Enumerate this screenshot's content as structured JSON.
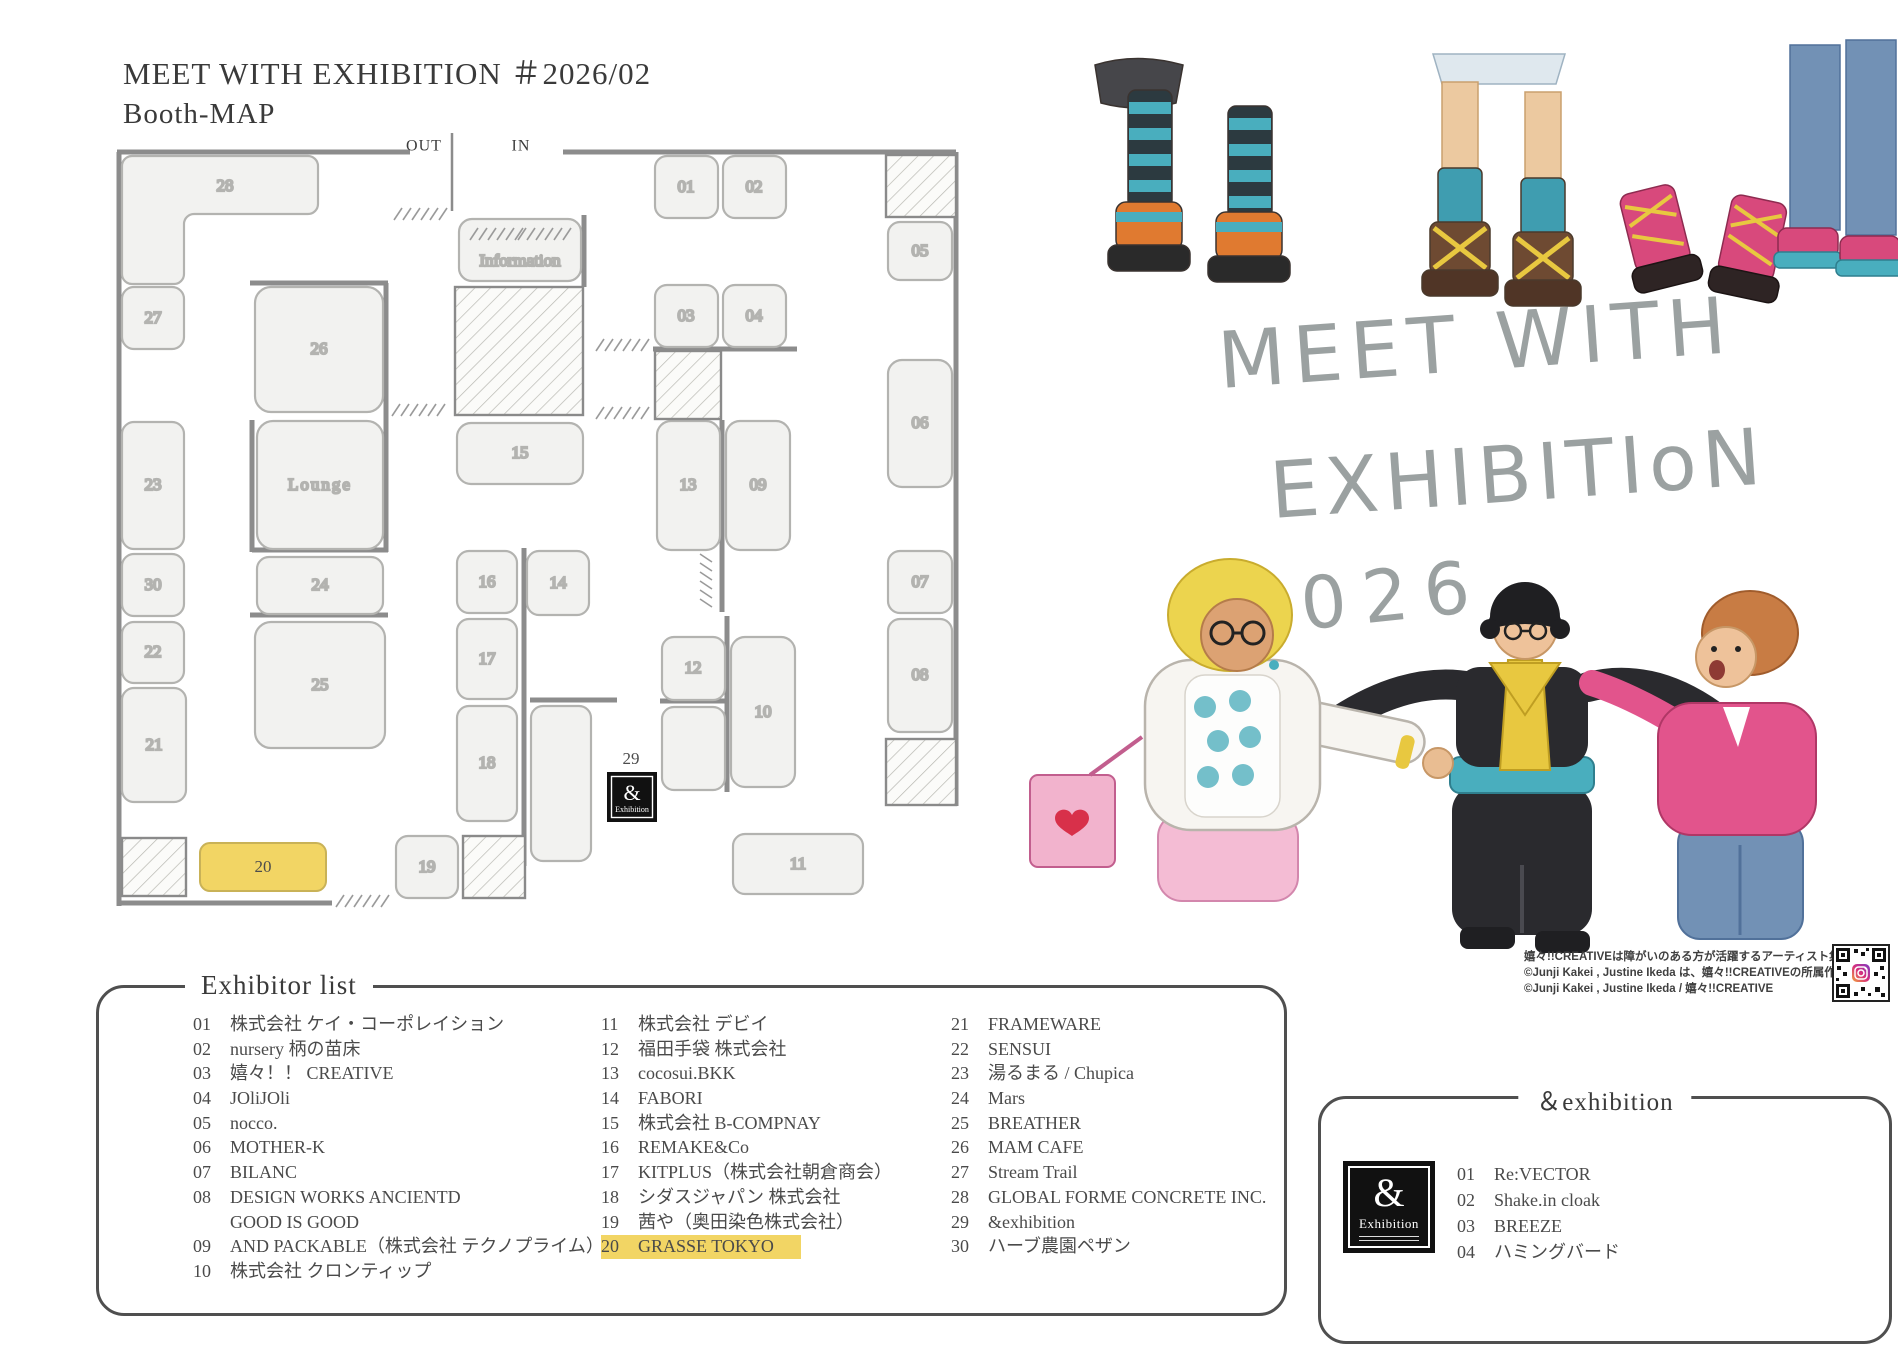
{
  "header": {
    "title": "MEET WITH EXHIBITION ＃2026/02",
    "subtitle": "Booth-MAP"
  },
  "map": {
    "out_label": "OUT",
    "in_label": "IN",
    "information_label": "Information",
    "lounge_label": "Lounge",
    "highlight_color": "#f2d564",
    "labels": {
      "b01": "01",
      "b02": "02",
      "b03": "03",
      "b04": "04",
      "b05": "05",
      "b06": "06",
      "b07": "07",
      "b08": "08",
      "b09": "09",
      "b10": "10",
      "b11": "11",
      "b12": "12",
      "b13": "13",
      "b14": "14",
      "b15": "15",
      "b16": "16",
      "b17": "17",
      "b18": "18",
      "b19": "19",
      "b20": "20",
      "b21": "21",
      "b22": "22",
      "b23": "23",
      "b24": "24",
      "b25": "25",
      "b26": "26",
      "b27": "27",
      "b28": "28",
      "b29": "29",
      "b30": "30"
    },
    "logo": {
      "amp": "&",
      "text": "Exhibition"
    }
  },
  "illustration": {
    "handwritten1": "MEET WITH",
    "handwritten2": "EXHIBITIoN",
    "handwritten3": "2026",
    "credits": {
      "line1": "嬉々!!CREATIVEは障がいのある方が活躍するアーティスト集団です！",
      "line2": "©Junji Kakei , Justine Ikeda は、嬉々!!CREATIVEの所属作家です。",
      "line3": "©Junji Kakei , Justine Ikeda / 嬉々!!CREATIVE"
    }
  },
  "exhibitor_list": {
    "title": "Exhibitor list",
    "col1": [
      {
        "no": "01",
        "name": "株式会社 ケイ・コーポレイション"
      },
      {
        "no": "02",
        "name": "nursery 柄の苗床"
      },
      {
        "no": "03",
        "name": "嬉々！！ CREATIVE"
      },
      {
        "no": "04",
        "name": "JOliJOli"
      },
      {
        "no": "05",
        "name": "nocco."
      },
      {
        "no": "06",
        "name": "MOTHER-K"
      },
      {
        "no": "07",
        "name": "BILANC"
      },
      {
        "no": "08",
        "name": "DESIGN WORKS ANCIENTD"
      },
      {
        "no": "",
        "name": "GOOD IS GOOD"
      },
      {
        "no": "09",
        "name": "AND PACKABLE（株式会社 テクノプライム）"
      },
      {
        "no": "10",
        "name": "株式会社 クロンティップ"
      }
    ],
    "col2": [
      {
        "no": "11",
        "name": "株式会社 デビイ"
      },
      {
        "no": "12",
        "name": "福田手袋 株式会社"
      },
      {
        "no": "13",
        "name": "cocosui.BKK"
      },
      {
        "no": "14",
        "name": "FABORI"
      },
      {
        "no": "15",
        "name": "株式会社 B-COMPNAY"
      },
      {
        "no": "16",
        "name": "REMAKE&Co"
      },
      {
        "no": "17",
        "name": "KITPLUS（株式会社朝倉商会）"
      },
      {
        "no": "18",
        "name": "シダスジャパン 株式会社"
      },
      {
        "no": "19",
        "name": "茜や（奥田染色株式会社）"
      },
      {
        "no": "20",
        "name": "GRASSE TOKYO"
      }
    ],
    "col3": [
      {
        "no": "21",
        "name": "FRAMEWARE"
      },
      {
        "no": "22",
        "name": "SENSUI"
      },
      {
        "no": "23",
        "name": "湯るまる / Chupica"
      },
      {
        "no": "24",
        "name": "Mars"
      },
      {
        "no": "25",
        "name": "BREATHER"
      },
      {
        "no": "26",
        "name": "MAM CAFE"
      },
      {
        "no": "27",
        "name": "Stream Trail"
      },
      {
        "no": "28",
        "name": "GLOBAL FORME CONCRETE INC."
      },
      {
        "no": "29",
        "name": "&exhibition"
      },
      {
        "no": "30",
        "name": "ハーブ農園ペザン"
      }
    ]
  },
  "and_exhibition": {
    "title": "＆exhibition",
    "logo": {
      "amp": "&",
      "text": "Exhibition"
    },
    "items": [
      {
        "no": "01",
        "name": "Re:VECTOR"
      },
      {
        "no": "02",
        "name": "Shake.in cloak"
      },
      {
        "no": "03",
        "name": "BREEZE"
      },
      {
        "no": "04",
        "name": "ハミングバード"
      }
    ]
  }
}
